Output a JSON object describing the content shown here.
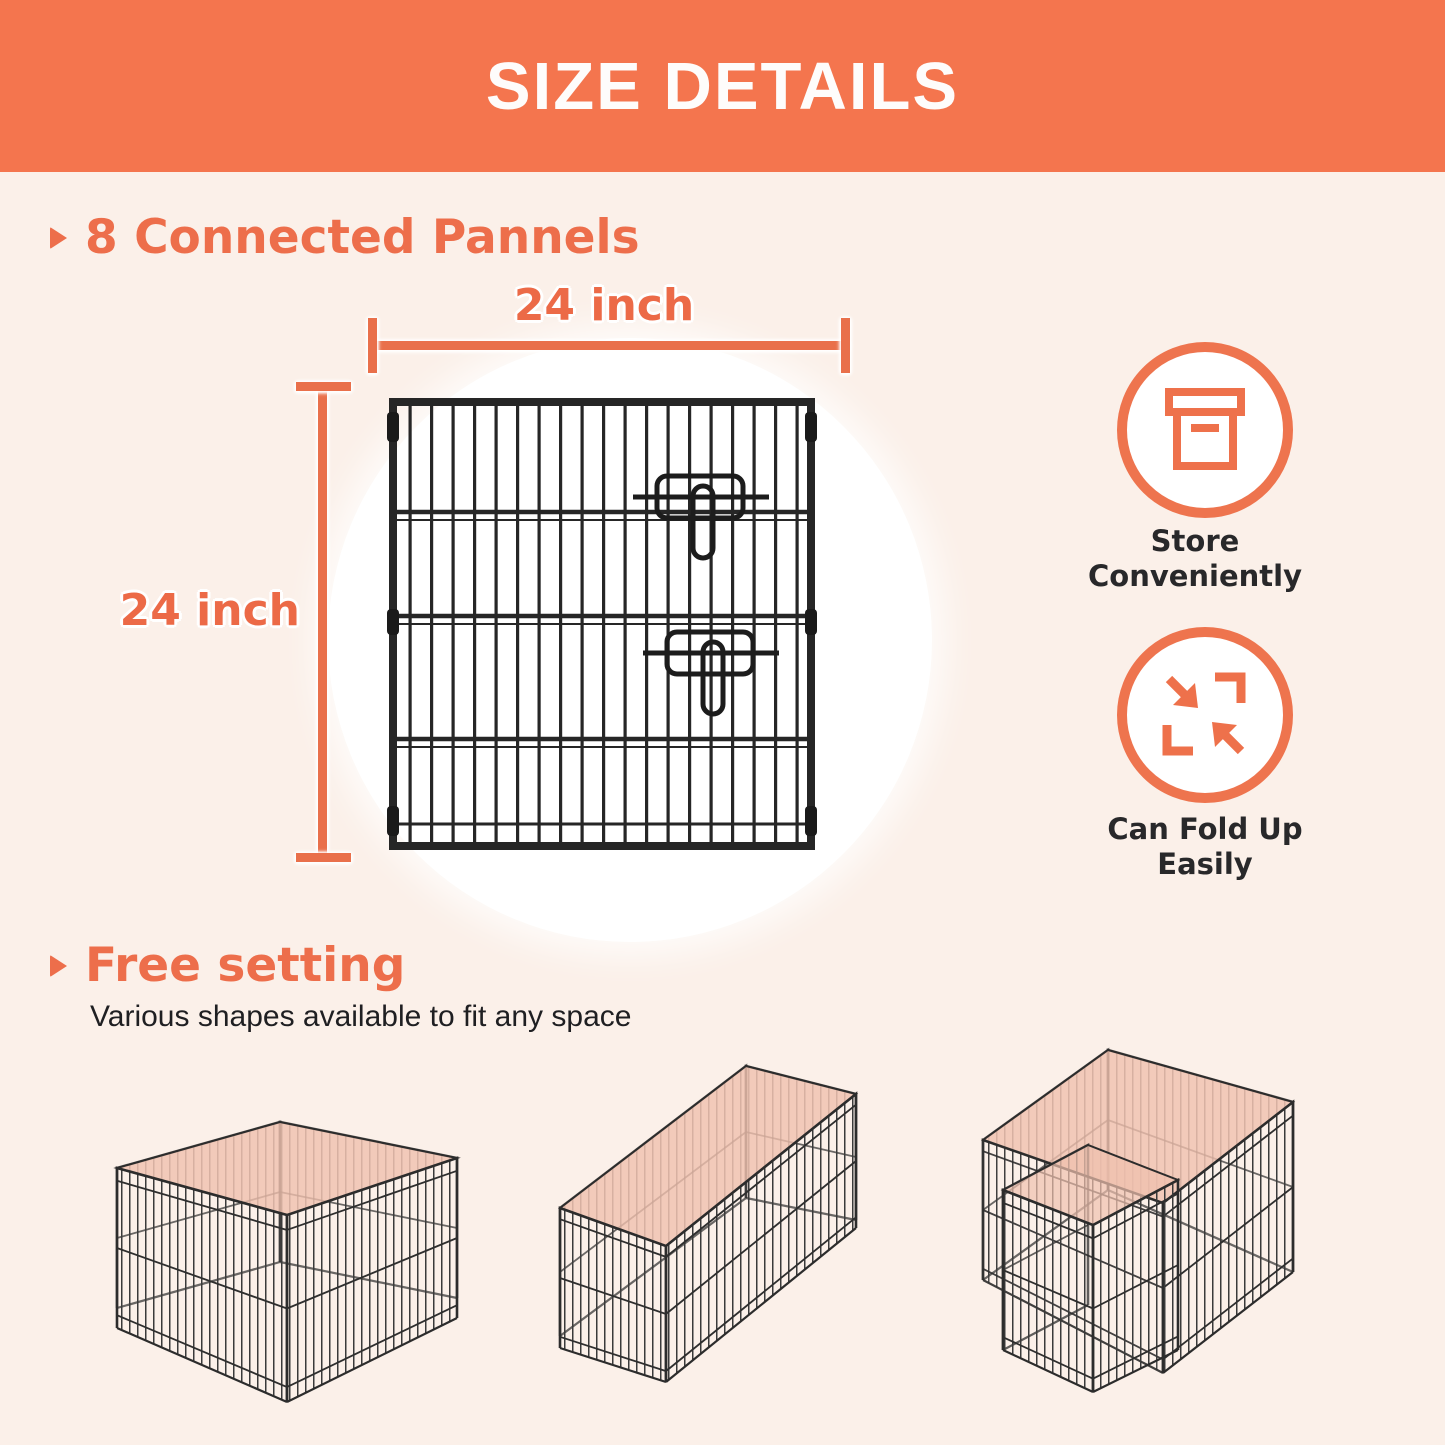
{
  "header": {
    "title": "SIZE DETAILS"
  },
  "panel_section": {
    "heading": "8 Connected Pannels",
    "dimension_width": "24 inch",
    "dimension_height": "24 inch",
    "image": "wire-panel"
  },
  "features": [
    {
      "icon": "storage-box-icon",
      "label": "Store Conveniently"
    },
    {
      "icon": "fold-arrows-icon",
      "label": "Can Fold Up Easily"
    }
  ],
  "free_setting_section": {
    "heading": "Free setting",
    "subheading": "Various shapes available to fit any space",
    "configurations": [
      "square-playpen",
      "rectangle-playpen",
      "l-shape-playpen"
    ]
  },
  "colors": {
    "banner": "#F4754E",
    "accent_text": "#ED6E4B",
    "dimension_line": "#E9704B",
    "background": "#FBF0E9",
    "playpen_top_tint": "#F0C0AE",
    "wire": "#333333",
    "text_dark": "#28282A"
  }
}
